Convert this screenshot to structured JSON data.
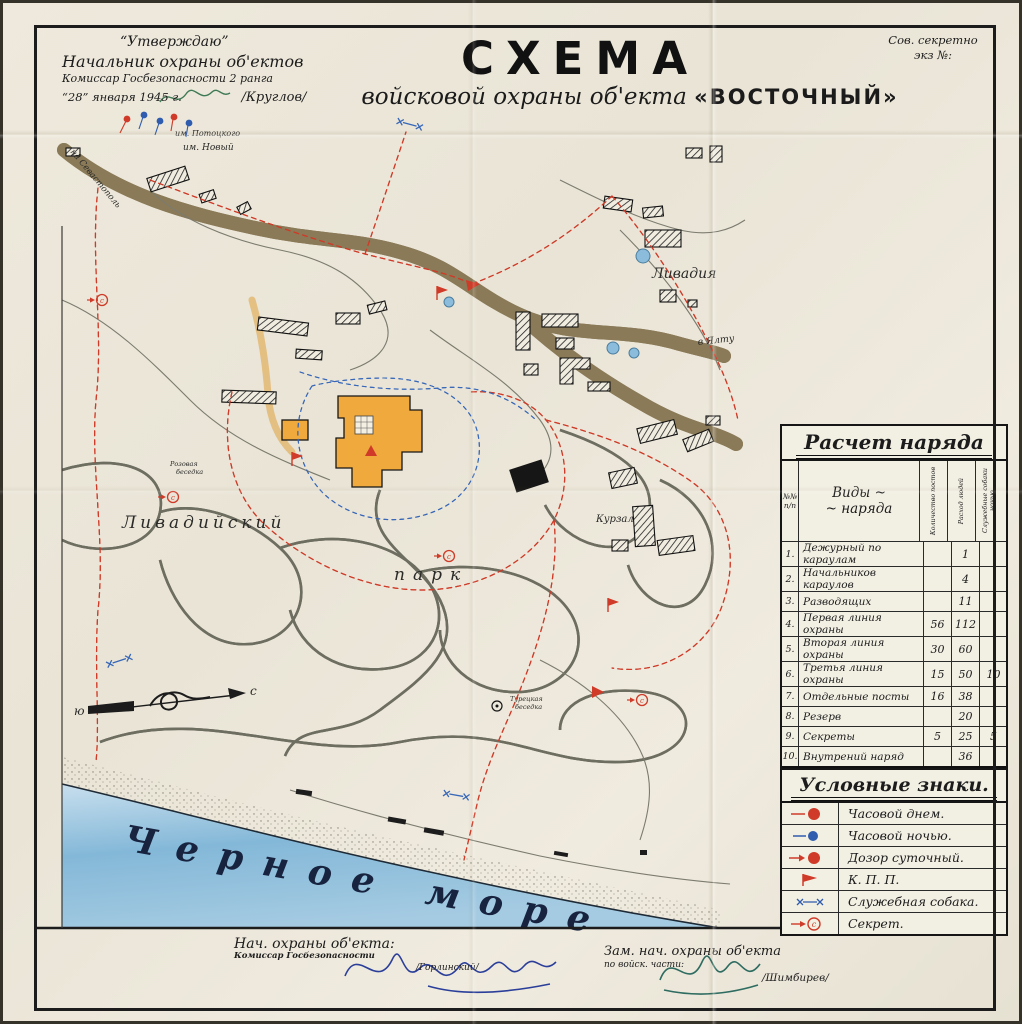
{
  "stamp": {
    "line1": "Сов. секретно",
    "line2": "экз №:"
  },
  "approval": {
    "approve": "“Утверждаю”",
    "role1": "Начальник охраны об'ектов",
    "role2": "Комиссар Госбезопасности 2 ранга",
    "date": "“28” января 1945 г.",
    "name": "/Круглов/"
  },
  "title": {
    "main": "СХЕМА",
    "sub": "войсковой охраны об'екта",
    "object": "«ВОСТОЧНЫЙ»"
  },
  "map": {
    "labels": {
      "sea": "Черное  море",
      "to_sevastopol": "на Севастополь",
      "to_yalta": "в Ялту",
      "livadia": "Ливадия",
      "estate1": "им. Потоцкого",
      "estate2": "им. Новый",
      "park1": "Ливадийский",
      "park2": "парк",
      "kurzal": "Курзал",
      "turkish1": "Турецкая",
      "turkish2": "беседка",
      "rose1": "Розовая",
      "rose2": "беседка"
    },
    "compass": {
      "south": "ю",
      "north": "с"
    }
  },
  "naryad": {
    "title": "Расчет наряда",
    "col_num1": "№№",
    "col_num2": "п/п",
    "col_kind1": "Виды  ~",
    "col_kind2": "~  наряда",
    "col_posts": "Количество постов",
    "col_people": "Расход людей",
    "col_dogs": "Служебные собаки ночью",
    "rows": [
      {
        "num": "1.",
        "name": "Дежурный по караулам",
        "posts": "",
        "people": "1",
        "dogs": ""
      },
      {
        "num": "2.",
        "name": "Начальников караулов",
        "posts": "",
        "people": "4",
        "dogs": ""
      },
      {
        "num": "3.",
        "name": "Разводящих",
        "posts": "",
        "people": "11",
        "dogs": ""
      },
      {
        "num": "4.",
        "name": "Первая линия охраны",
        "posts": "56",
        "people": "112",
        "dogs": ""
      },
      {
        "num": "5.",
        "name": "Вторая линия охраны",
        "posts": "30",
        "people": "60",
        "dogs": ""
      },
      {
        "num": "6.",
        "name": "Третья линия охраны",
        "posts": "15",
        "people": "50",
        "dogs": "10"
      },
      {
        "num": "7.",
        "name": "Отдельные посты",
        "posts": "16",
        "people": "38",
        "dogs": ""
      },
      {
        "num": "8.",
        "name": "Резерв",
        "posts": "",
        "people": "20",
        "dogs": ""
      },
      {
        "num": "9.",
        "name": "Секреты",
        "posts": "5",
        "people": "25",
        "dogs": "5"
      },
      {
        "num": "10.",
        "name": "Внутрений наряд",
        "posts": "",
        "people": "36",
        "dogs": ""
      }
    ],
    "total": {
      "label": "И Т О Г О:",
      "posts": "122",
      "people": "359",
      "dogs": "15"
    }
  },
  "legend": {
    "title": "Условные знаки.",
    "items": [
      {
        "icon": "sentry-day-icon",
        "label": "Часовой днем."
      },
      {
        "icon": "sentry-night-icon",
        "label": "Часовой ночью."
      },
      {
        "icon": "patrol-icon",
        "label": "Дозор суточный."
      },
      {
        "icon": "checkpoint-flag-icon",
        "label": "К. П. П."
      },
      {
        "icon": "service-dog-icon",
        "label": "Служебная собака."
      },
      {
        "icon": "secret-post-icon",
        "label": "Секрет."
      }
    ]
  },
  "signatures": {
    "left_role": "Нач. охраны об'екта:",
    "left_rank": "Комиссар Госбезопасности",
    "left_name": "/Горлинский/",
    "right_role": "Зам. нач. охраны об'екта",
    "right_sub": "по войск. части:",
    "right_name": "/Шимбирев/"
  }
}
